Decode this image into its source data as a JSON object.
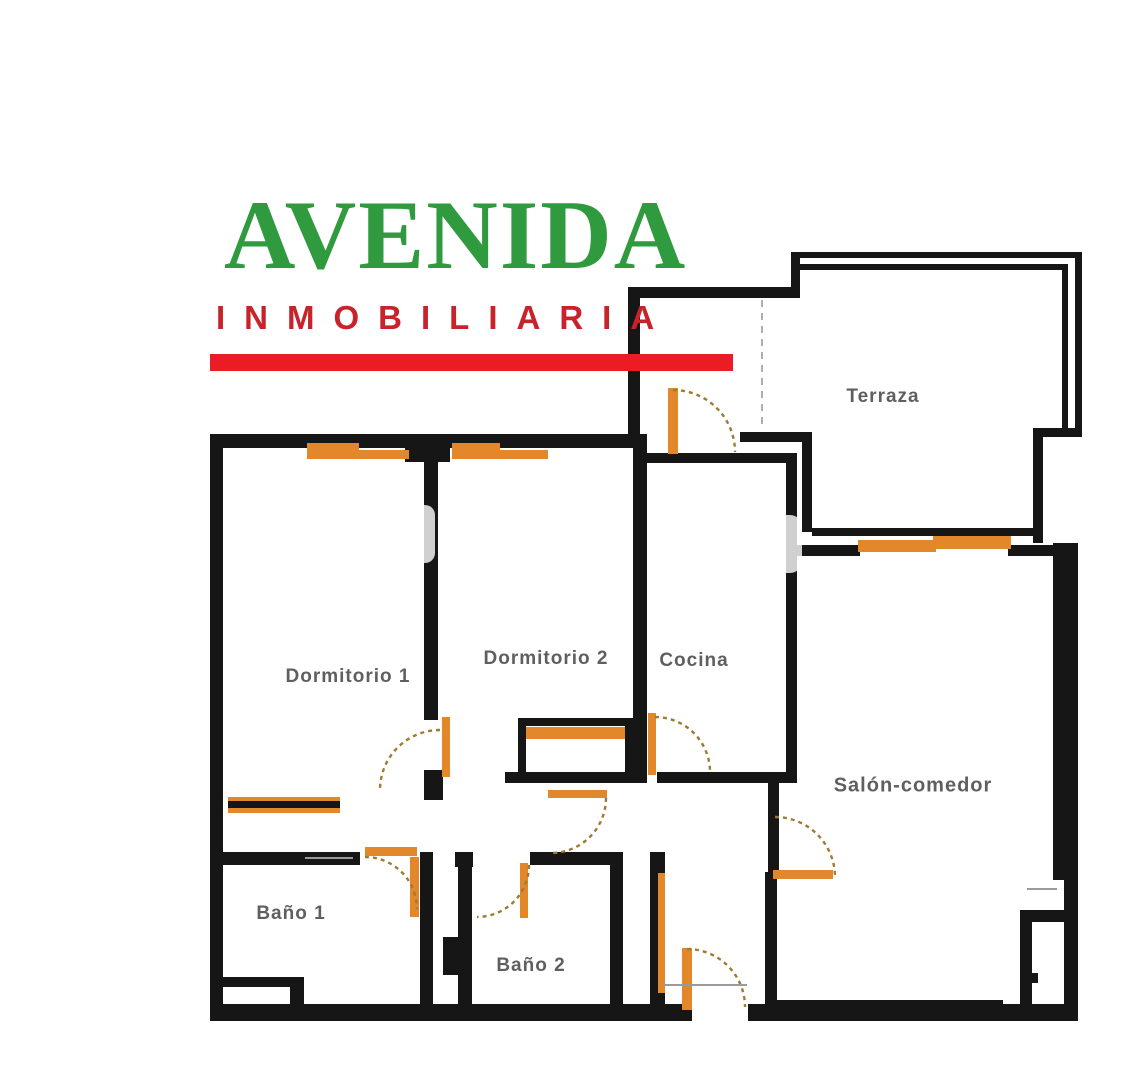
{
  "logo": {
    "brand": "AVENIDA",
    "subtitle": "INMOBILIARIA"
  },
  "floor_plan": {
    "rooms": {
      "terraza": {
        "label": "Terraza"
      },
      "dormitorio1": {
        "label": "Dormitorio 1"
      },
      "dormitorio2": {
        "label": "Dormitorio 2"
      },
      "cocina": {
        "label": "Cocina"
      },
      "salon": {
        "label": "Salón-comedor"
      },
      "bano1": {
        "label": "Baño 1"
      },
      "bano2": {
        "label": "Baño 2"
      }
    }
  },
  "colors": {
    "brand_green": "#2f9a3e",
    "brand_red": "#c8222b",
    "accent_bar_red": "#ec1c24",
    "joinery_orange": "#e2882a",
    "arc_brown": "#a07a32",
    "wall_black": "#161616",
    "label_gray": "#5f5f5f"
  }
}
